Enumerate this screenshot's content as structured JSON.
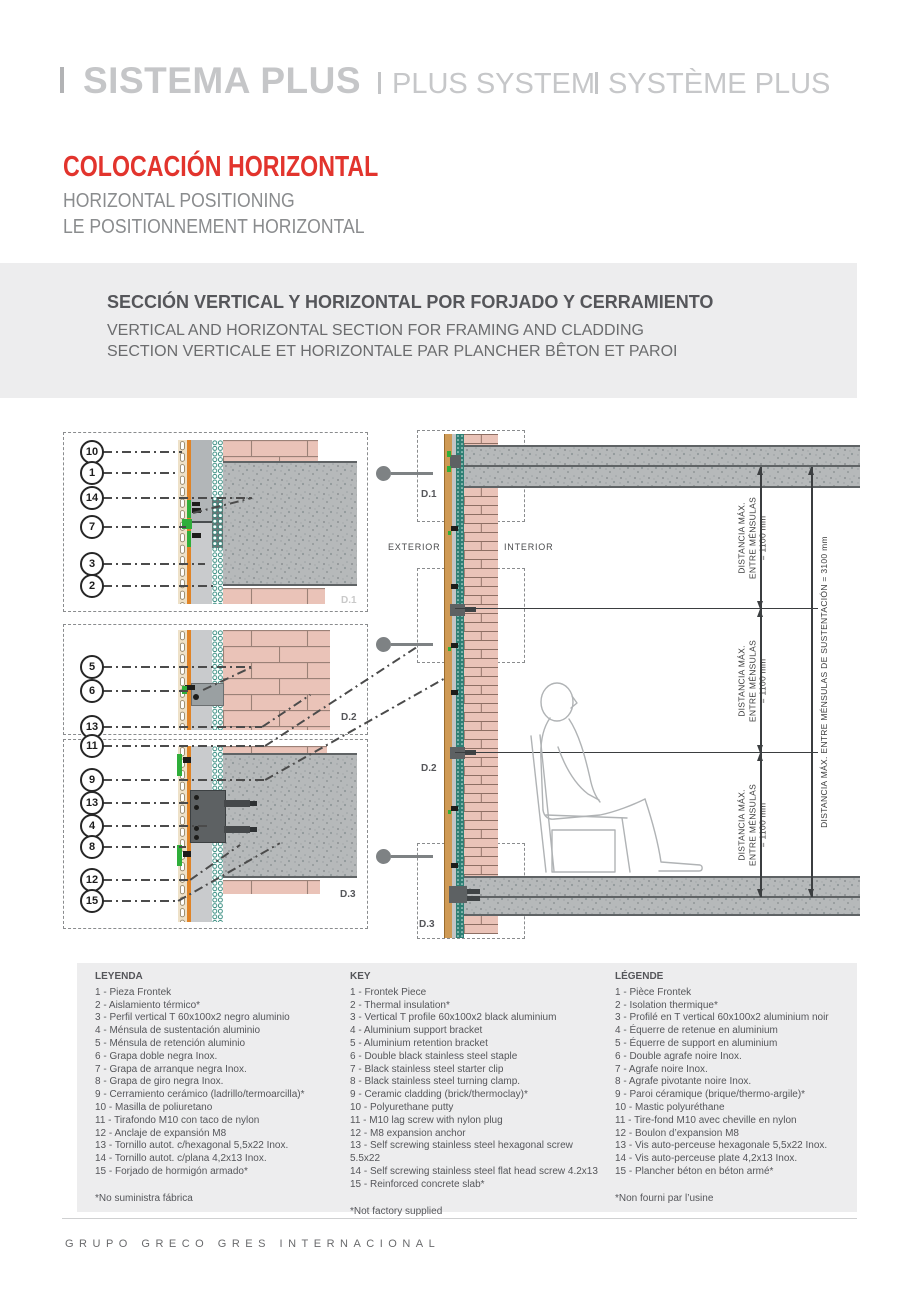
{
  "header": {
    "brand": {
      "primary": "SISTEMA PLUS",
      "secondary": "PLUS SYSTEM",
      "tertiary": "SYSTÈME PLUS"
    },
    "title": {
      "es": "COLOCACIÓN HORIZONTAL",
      "en": "HORIZONTAL POSITIONING",
      "fr": "LE POSITIONNEMENT HORIZONTAL"
    }
  },
  "section": {
    "es": "SECCIÓN VERTICAL Y HORIZONTAL POR FORJADO Y CERRAMIENTO",
    "en": "VERTICAL AND HORIZONTAL SECTION FOR FRAMING AND CLADDING",
    "fr": "SECTION VERTICALE ET HORIZONTALE PAR PLANCHER BÊTON ET PAROI"
  },
  "diagram": {
    "exterior": "EXTERIOR",
    "interior": "INTERIOR",
    "details": {
      "d1": "D.1",
      "d2": "D.2",
      "d3": "D.3"
    },
    "callouts": {
      "box1": [
        "10",
        "1",
        "14",
        "7",
        "3",
        "2"
      ],
      "box2": [
        "5",
        "6",
        "13"
      ],
      "box3": [
        "11",
        "9",
        "13",
        "4",
        "8",
        "12",
        "15"
      ]
    },
    "dimensions": {
      "bracket_spacing_lines": [
        "DISTANCIA MÁX.",
        "ENTRE MÉNSULAS",
        "= 1100 mm"
      ],
      "total_spacing": "DISTANCIA MÁX. ENTRE MÉNSULAS DE SUSTENTACIÓN = 3100 mm"
    }
  },
  "legend": {
    "columns": [
      {
        "title": "LEYENDA",
        "items": [
          "1 - Pieza Frontek",
          "2 - Aislamiento térmico*",
          "3 - Perfil vertical T 60x100x2 negro aluminio",
          "4 - Ménsula de sustentación aluminio",
          "5 - Ménsula de retención aluminio",
          "6 - Grapa doble negra Inox.",
          "7 - Grapa de arranque negra Inox.",
          "8 - Grapa de giro negra Inox.",
          "9 - Cerramiento cerámico (ladrillo/termoarcilla)*",
          "10 - Masilla de poliuretano",
          "11 - Tirafondo M10 con taco de nylon",
          "12 - Anclaje de expansión M8",
          "13 - Tornillo autot. c/hexagonal 5,5x22 Inox.",
          "14 - Tornillo autot. c/plana 4,2x13 Inox.",
          "15 - Forjado de hormigón armado*"
        ],
        "footnote": "*No suministra fábrica"
      },
      {
        "title": "KEY",
        "items": [
          "1 - Frontek Piece",
          "2 - Thermal insulation*",
          "3 - Vertical T profile 60x100x2 black aluminium",
          "4 - Aluminium support bracket",
          "5 - Aluminium retention bracket",
          "6 - Double black stainless steel staple",
          "7 - Black stainless steel starter clip",
          "8 - Black stainless steel turning clamp.",
          "9 - Ceramic cladding (brick/thermoclay)*",
          "10 - Polyurethane putty",
          "11 - M10 lag screw with nylon plug",
          "12 - M8 expansion anchor",
          "13 - Self screwing stainless steel hexagonal screw 5.5x22",
          "14 - Self screwing stainless steel flat head screw 4.2x13",
          "15 - Reinforced concrete slab*"
        ],
        "footnote": "*Not factory supplied"
      },
      {
        "title": "LÉGENDE",
        "items": [
          "1 - Pièce Frontek",
          "2 - Isolation thermique*",
          "3 - Profilé en T vertical 60x100x2 aluminium noir",
          "4 - Équerre de retenue en aluminium",
          "5 - Équerre de support en aluminium",
          "6 - Double agrafe noire Inox.",
          "7 - Agrafe noire Inox.",
          "8 - Agrafe pivotante noire Inox.",
          "9 - Paroi céramique (brique/thermo-argile)*",
          "10 - Mastic polyuréthane",
          "11 - Tire-fond M10 avec cheville en nylon",
          "12 - Boulon d’expansion M8",
          "13 - Vis auto-perceuse hexagonale 5,5x22 Inox.",
          "14 - Vis auto-perceuse plate 4,2x13 Inox.",
          "15 - Plancher béton en béton armé*"
        ],
        "footnote": "*Non fourni par l’usine"
      }
    ]
  },
  "footer": {
    "company": "GRUPO GRECO GRES INTERNACIONAL"
  },
  "colors": {
    "accent_red": "#e2342d",
    "brand_gray": "#c5c6c8",
    "text_dark": "#55565a",
    "text_mid": "#6b6c6e",
    "band_bg": "#ededee",
    "brick": "#eac3b8",
    "insulation_teal": "#2e7f74",
    "orange": "#e08427",
    "green_clip": "#2fae3a",
    "concrete": "#b6b9ba"
  }
}
